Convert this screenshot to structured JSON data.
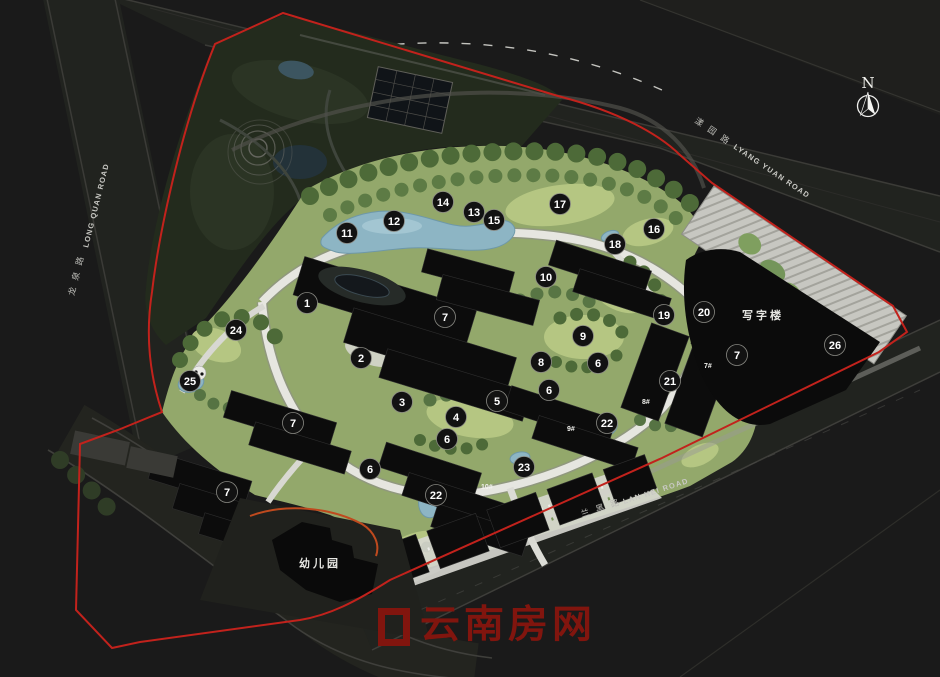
{
  "colors": {
    "background": "#1a1a1a",
    "boundary_red": "#c2221c",
    "water_blue": "#8db5c4",
    "marker_fill": "#121212",
    "marker_text": "#ffffff",
    "watermark_red": "#81150e"
  },
  "north": {
    "label": "N"
  },
  "roads": [
    {
      "id": "lyang-yuan",
      "zh": "漾园路",
      "en": "LYANG YUAN ROAD"
    },
    {
      "id": "long-quan",
      "zh": "龙泉路",
      "en": "LONG QUAN ROAD"
    },
    {
      "id": "lan-hei",
      "zh": "兰黑路",
      "en": "LAN HEI ROAD"
    }
  ],
  "site_labels": [
    {
      "id": "office",
      "text": "写字楼",
      "x": 763,
      "y": 319
    },
    {
      "id": "kindergarten",
      "text": "幼儿园",
      "x": 320,
      "y": 567
    }
  ],
  "building_labels": [
    {
      "text": "7#",
      "x": 704,
      "y": 368
    },
    {
      "text": "8#",
      "x": 642,
      "y": 404
    },
    {
      "text": "9#",
      "x": 567,
      "y": 431
    },
    {
      "text": "10#",
      "x": 481,
      "y": 489
    }
  ],
  "markers": [
    {
      "n": "1",
      "x": 307,
      "y": 303
    },
    {
      "n": "2",
      "x": 361,
      "y": 358
    },
    {
      "n": "3",
      "x": 402,
      "y": 402
    },
    {
      "n": "4",
      "x": 456,
      "y": 417
    },
    {
      "n": "5",
      "x": 497,
      "y": 401
    },
    {
      "n": "6",
      "x": 598,
      "y": 363
    },
    {
      "n": "6",
      "x": 549,
      "y": 390
    },
    {
      "n": "6",
      "x": 447,
      "y": 439
    },
    {
      "n": "6",
      "x": 370,
      "y": 469
    },
    {
      "n": "7",
      "x": 445,
      "y": 317
    },
    {
      "n": "7",
      "x": 737,
      "y": 355
    },
    {
      "n": "7",
      "x": 293,
      "y": 423
    },
    {
      "n": "7",
      "x": 227,
      "y": 492
    },
    {
      "n": "8",
      "x": 541,
      "y": 362
    },
    {
      "n": "9",
      "x": 583,
      "y": 336
    },
    {
      "n": "10",
      "x": 546,
      "y": 277
    },
    {
      "n": "11",
      "x": 347,
      "y": 233
    },
    {
      "n": "12",
      "x": 394,
      "y": 221
    },
    {
      "n": "13",
      "x": 474,
      "y": 212
    },
    {
      "n": "14",
      "x": 443,
      "y": 202
    },
    {
      "n": "15",
      "x": 494,
      "y": 220
    },
    {
      "n": "16",
      "x": 654,
      "y": 229
    },
    {
      "n": "17",
      "x": 560,
      "y": 204
    },
    {
      "n": "18",
      "x": 615,
      "y": 244
    },
    {
      "n": "19",
      "x": 664,
      "y": 315
    },
    {
      "n": "20",
      "x": 704,
      "y": 312
    },
    {
      "n": "21",
      "x": 670,
      "y": 381
    },
    {
      "n": "22",
      "x": 607,
      "y": 423
    },
    {
      "n": "22",
      "x": 436,
      "y": 495
    },
    {
      "n": "23",
      "x": 524,
      "y": 467
    },
    {
      "n": "24",
      "x": 236,
      "y": 330
    },
    {
      "n": "25",
      "x": 190,
      "y": 381
    },
    {
      "n": "26",
      "x": 835,
      "y": 345
    }
  ],
  "watermark": {
    "text": "云南房网"
  }
}
